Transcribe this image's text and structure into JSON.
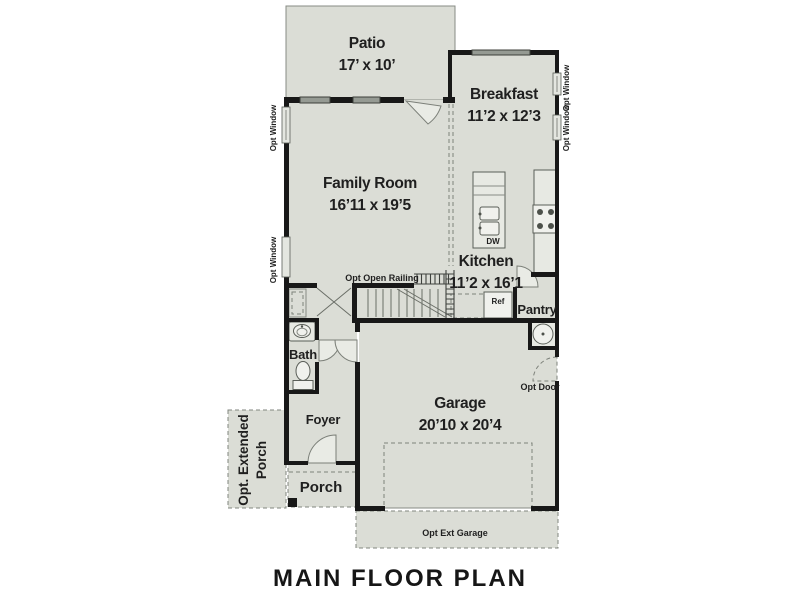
{
  "title": "MAIN FLOOR PLAN",
  "rooms": {
    "patio": {
      "name": "Patio",
      "dims": "17’ x 10’"
    },
    "breakfast": {
      "name": "Breakfast",
      "dims": "11’2 x 12’3"
    },
    "family_room": {
      "name": "Family Room",
      "dims": "16’11 x 19’5"
    },
    "kitchen": {
      "name": "Kitchen",
      "dims": "11’2 x 16’1"
    },
    "garage": {
      "name": "Garage",
      "dims": "20’10 x 20’4"
    },
    "bath": {
      "name": "Bath"
    },
    "foyer": {
      "name": "Foyer"
    },
    "porch": {
      "name": "Porch"
    },
    "pantry": {
      "name": "Pantry"
    },
    "extended_porch": {
      "line1": "Opt. Extended",
      "line2": "Porch"
    }
  },
  "annotations": {
    "opt_open_railing": "Opt Open Railing",
    "opt_door": "Opt Door",
    "opt_ext_garage": "Opt Ext Garage",
    "opt_window": "Opt Window",
    "dishwasher": "DW",
    "refrigerator": "Ref"
  },
  "colors": {
    "floor": "#dbddd6",
    "wall": "#181818",
    "background": "#ffffff",
    "text": "#1f1f1f"
  }
}
